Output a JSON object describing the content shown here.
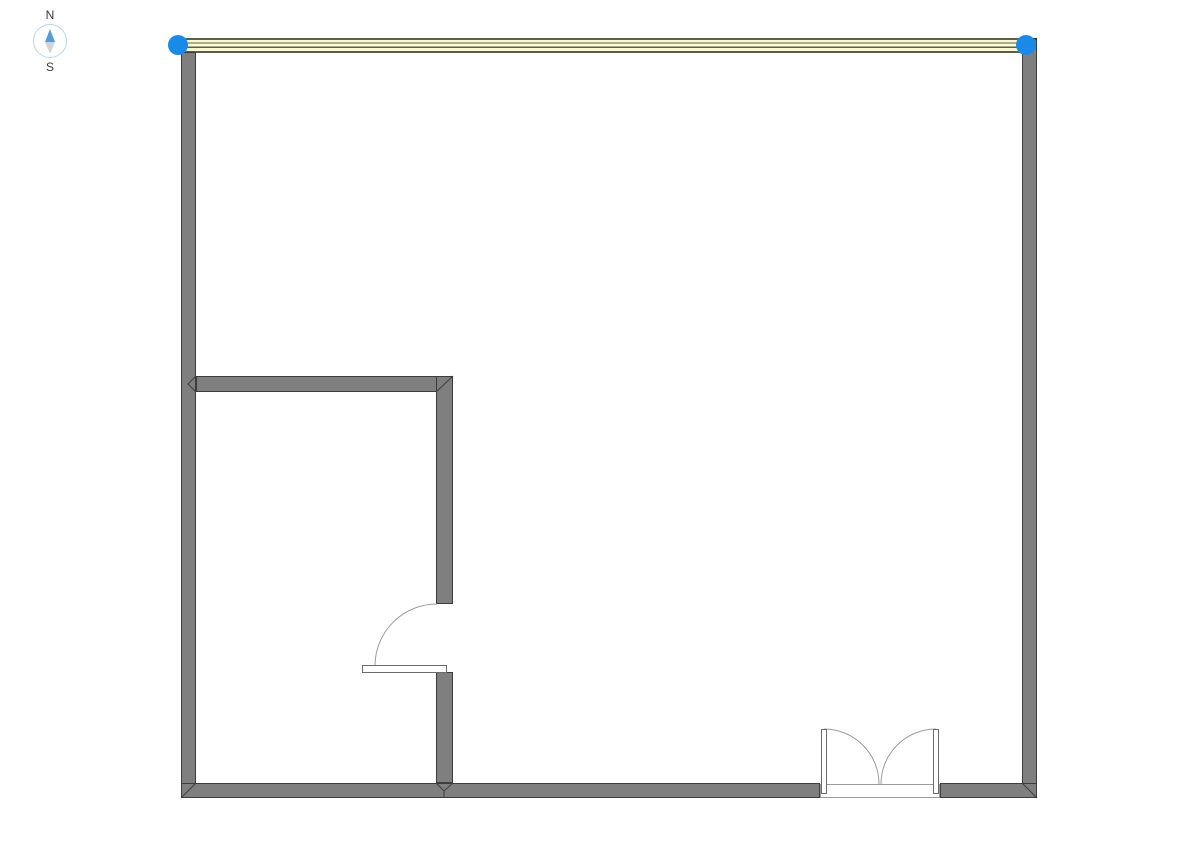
{
  "canvas": {
    "width": 1190,
    "height": 841,
    "background": "#ffffff"
  },
  "compass": {
    "north_label": "N",
    "south_label": "S"
  },
  "colors": {
    "wall_fill": "#7f7f7f",
    "wall_outline": "#3d3d3d",
    "selected_wall_stripe_light": "#fafad2",
    "selected_wall_stripe_dark": "#5e5e49",
    "selection_handle": "#1a8ae8",
    "door_arc": "#9b9b9b",
    "door_leaf_fill": "#ffffff",
    "door_leaf_outline": "#6b6b6b",
    "compass_north_needle": "#5b9bd5",
    "compass_south_needle": "#d2d2d8",
    "compass_ring": "#b5d5ee"
  },
  "floorplan": {
    "walls": [
      {
        "name": "north-wall-selected",
        "type": "layered",
        "x": 179,
        "y": 38,
        "w": 858,
        "h": 15,
        "stripes": [
          {
            "dy": 0,
            "h": 2
          },
          {
            "dy": 4.3,
            "h": 1.4
          },
          {
            "dy": 8.6,
            "h": 1.4
          },
          {
            "dy": 13,
            "h": 2
          }
        ]
      },
      {
        "name": "west-wall",
        "type": "solid",
        "x": 181,
        "y": 52,
        "w": 15,
        "h": 746
      },
      {
        "name": "east-wall",
        "type": "solid",
        "x": 1022,
        "y": 38,
        "w": 15,
        "h": 760
      },
      {
        "name": "south-wall-west-segment",
        "type": "solid",
        "x": 181,
        "y": 783,
        "w": 639,
        "h": 15
      },
      {
        "name": "south-wall-east-segment",
        "type": "solid",
        "x": 940,
        "y": 783,
        "w": 97,
        "h": 15
      },
      {
        "name": "interior-wall-horizontal",
        "type": "solid",
        "x": 196,
        "y": 376,
        "w": 257,
        "h": 16
      },
      {
        "name": "interior-wall-vertical-upper",
        "type": "solid",
        "x": 436,
        "y": 376,
        "w": 17,
        "h": 228
      },
      {
        "name": "interior-wall-vertical-lower",
        "type": "solid",
        "x": 436,
        "y": 672,
        "w": 17,
        "h": 111
      }
    ],
    "joints": [
      {
        "name": "miter-top-right-corner",
        "d": "M 1037 38 L 1022 53"
      },
      {
        "name": "miter-bottom-left-corner",
        "d": "M 196 783 L 181 798"
      },
      {
        "name": "miter-bottom-right-corner",
        "d": "M 1022 783 L 1037 798"
      },
      {
        "name": "miter-interior-corner",
        "d": "M 453 376 L 436 392"
      },
      {
        "name": "miter-interior-west-junction",
        "d": "M 196 376 L 188 384 L 196 392"
      },
      {
        "name": "miter-interior-south-junction",
        "d": "M 436 783 L 444 791 L 453 783 M 444 791 L 444 798"
      }
    ],
    "doors": [
      {
        "name": "interior-single-door",
        "leaves": [
          {
            "x": 362,
            "y": 665,
            "w": 85,
            "h": 8
          }
        ],
        "arcs": [
          "M 375 665 A 62 62 0 0 1 437 604"
        ]
      },
      {
        "name": "exterior-double-door",
        "threshold": {
          "x": 820,
          "y": 784,
          "w": 120,
          "h": 14
        },
        "leaves": [
          {
            "x": 821,
            "y": 729,
            "w": 6,
            "h": 65
          },
          {
            "x": 933,
            "y": 729,
            "w": 6,
            "h": 65
          }
        ],
        "arcs": [
          "M 824 729 A 55 55 0 0 1 879 784",
          "M 936 729 A 55 55 0 0 0 881 784"
        ]
      }
    ],
    "selection_handles": [
      {
        "name": "selection-handle-west-endpoint",
        "cx": 178,
        "cy": 45,
        "r": 10
      },
      {
        "name": "selection-handle-east-endpoint",
        "cx": 1026,
        "cy": 45,
        "r": 10
      }
    ]
  }
}
